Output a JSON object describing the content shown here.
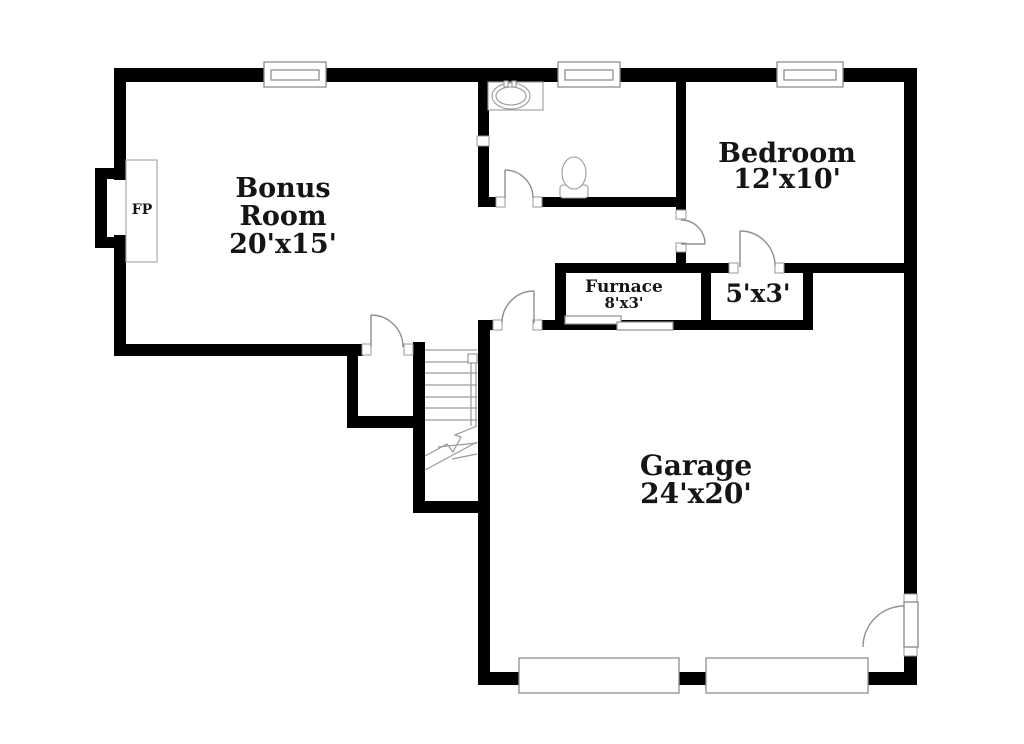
{
  "document_type": "floor plan",
  "colors": {
    "wall": "#000000",
    "fixture_line": "#8f8f8f",
    "background": "#ffffff",
    "text": "#151515"
  },
  "rooms": {
    "bonus": {
      "name": "Bonus Room",
      "dimensions": "20'x15'"
    },
    "bedroom": {
      "name": "Bedroom",
      "dimensions": "12'x10'"
    },
    "garage": {
      "name": "Garage",
      "dimensions": "24'x20'"
    },
    "furnace": {
      "name": "Furnace",
      "dimensions": "8'x3'"
    },
    "closet": {
      "dimensions": "5'x3'"
    },
    "fireplace": {
      "label": "FP"
    }
  },
  "visible_symbol_counts": {
    "windows": 3,
    "garage_door_panels": 2,
    "swing_doors": 6,
    "sliding_door_panels": 2,
    "staircases": 1
  }
}
